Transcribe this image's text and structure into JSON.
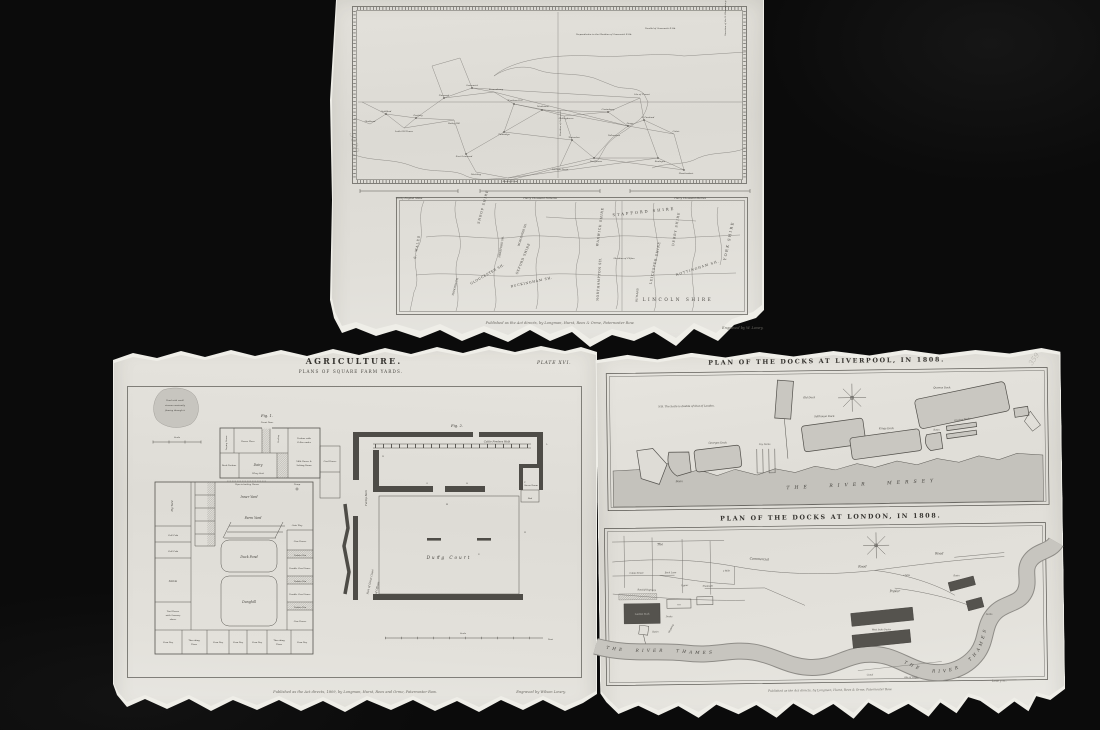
{
  "survey": {
    "pencil": "5129",
    "trig": {
      "parallel": "Parallel of Greenwich R.Ob.",
      "perpendicular": "Perpendicular to the Meridian of Greenwich R.Ob.",
      "paris": "Direction of the R. Observatory at Paris",
      "meridian": "Meridian of Greenwich",
      "places": [
        "Hindhead",
        "Guildford",
        "Leith Hill Tower",
        "Dorking",
        "Norwood",
        "Greenwich",
        "Severndroog",
        "Botley Hill",
        "Wrotham Hill",
        "Maidstone",
        "Hollingbourn",
        "Tunbridge",
        "East Grinstead",
        "Ditchling",
        "Beachy Head",
        "Fairlight Down",
        "Tenterden",
        "Dungeness",
        "Folkestone",
        "Dover",
        "S. Foreland",
        "Canterbury",
        "Isle of Thanet",
        "Boulogne",
        "Montlambert",
        "Calais"
      ]
    },
    "scales": [
      "Thirty English Miles",
      "Thirty Thousand Fathoms",
      "Thirty Thousand Metres"
    ],
    "county": {
      "names": [
        "SHROP SHIRE",
        "STAFFORD SHIRE",
        "DERBY SHIRE",
        "NOTTINGHAM SH.",
        "YORK SHIRE",
        "LINCOLN SHIRE",
        "LEICESTER SHIRE",
        "RUTLAND",
        "WARWICK SHIRE",
        "NORTHAMPTON SH.",
        "BUCKINGHAM SH.",
        "OXFORD SHIRE",
        "GLOUCESTER SH.",
        "WORCESTER SH.",
        "HEREFORD SH.",
        "S. WALES",
        "MONMOUTH"
      ],
      "meridian_note": "Meridian of Clifton"
    },
    "imprint": "Published as the Act directs, by Longman, Hurst, Rees & Orme, Paternoster Row.",
    "engraver": "Engraved by W. Lowry."
  },
  "agri": {
    "title": "AGRICULTURE.",
    "subtitle": "PLANS OF SQUARE FARM YARDS.",
    "plate": "PLATE XVI.",
    "imprint": "Published as the Act directs, 1809, by Longman, Hurst, Rees and Orme, Paternoster Row.",
    "engraver": "Engraved by Wilson Lowry.",
    "fig1": {
      "label": "Fig. 1.",
      "front_door": "Front Door",
      "pond": [
        "Pond with small",
        "stream constantly",
        "flowing through it"
      ],
      "scale": "Scale",
      "drying": "Drying Room",
      "house_place": "House Place",
      "poultry": "Poultry",
      "parlour": [
        "Parlour with",
        "Cellar under"
      ],
      "back_parlour": "Back Parlour",
      "dairy": "Dairy",
      "whey": "Whey Sink",
      "milk": [
        "Milk House &",
        "Salting Room"
      ],
      "pipe": "Pipe to boiling House",
      "pump": "Pump",
      "coal": "Coal House",
      "pig_yard": "Pig Yard",
      "inner_yard": "Inner Yard",
      "farm_yard": "Farm Yard",
      "gate": "Gate Way",
      "duck_pond": "Duck Pond",
      "dunghill": "Dunghill",
      "stable": "Stable",
      "calf": "Calf Crib",
      "tool": [
        "Tool House",
        "with Granary",
        "above"
      ],
      "cow": "Cow House",
      "double_cow": "Double Cow House",
      "fodder": "Fodder Bin",
      "corn": "Corn Bay",
      "thresh": [
        "Threshing",
        "Floor"
      ]
    },
    "fig2": {
      "label": "Fig. 2.",
      "feeders": "Cattle Feeders Walk",
      "turnip": "Turnip Barn",
      "dung": "Dung Court",
      "bed": "Bed",
      "straw": "Straw Room",
      "court": [
        "Part of Great Court",
        "of Offices"
      ],
      "scale": "Scale",
      "feet": "Feet",
      "letters": [
        "B",
        "G",
        "O",
        "M",
        "F",
        "L",
        "E",
        "W",
        "H"
      ]
    }
  },
  "docks": {
    "pencil": "359",
    "liverpool": {
      "title": "PLAN OF THE DOCKS AT LIVERPOOL, IN 1808.",
      "note": "N.B. The Scale is double of that of London.",
      "old": "Old Dock",
      "georges": "Georges Dock",
      "basin": "Basin",
      "dry": "Dry Docks",
      "salthouse": "Salthouse Dock",
      "kings": "Kings Dock",
      "graving": "Graving Docks",
      "queens": "Queens Dock",
      "river": "THE RIVER MERSEY"
    },
    "london": {
      "title": "PLAN OF THE DOCKS AT LONDON, IN 1808.",
      "the": "The",
      "commercial": "Commercial",
      "road": "Road",
      "cable": "Cable Street",
      "back_lane": "Back Lane",
      "upper": "Upper",
      "shadwell": "Shadwell",
      "ratcliff": "Ratcliff Highway",
      "wapping": "Wapping",
      "mile": "a Mile",
      "poplar": "Poplar",
      "london_dock": "London Dock",
      "aa": "a.a",
      "docks": "Docks",
      "basin": "Basin",
      "west_india": "West India Docks",
      "canal": "Canal",
      "isle": "Isle of Dogs",
      "river": "THE RIVER THAMES"
    },
    "imprint": "Published as the Act directs, by Longman, Hurst, Rees & Orme, Paternoster Row.",
    "engraver": "Lowry sc."
  }
}
